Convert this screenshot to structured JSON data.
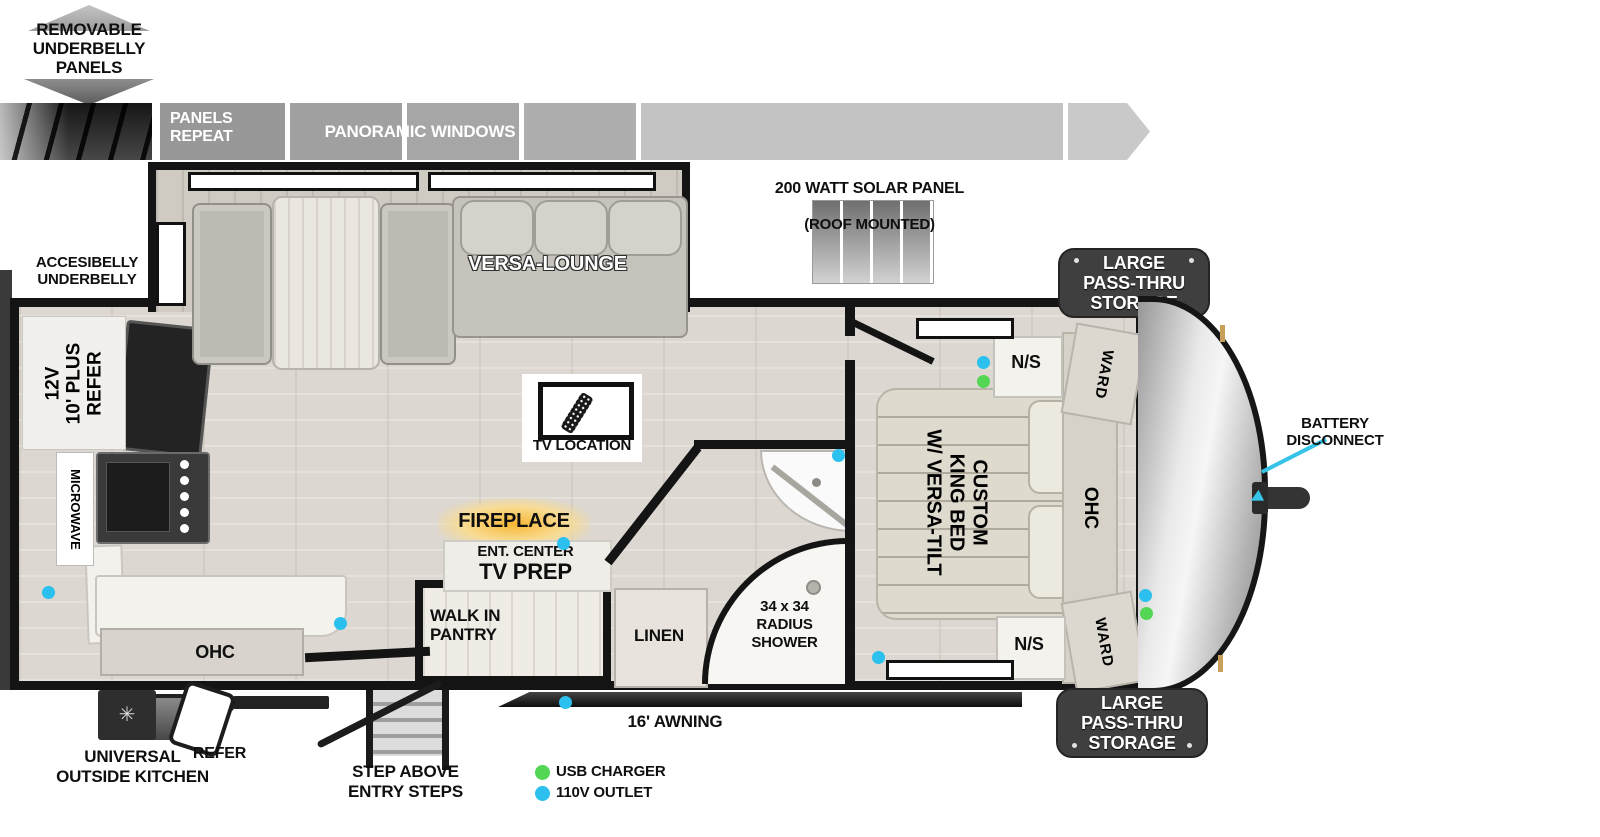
{
  "colors": {
    "wall": "#141414",
    "floor": "#dcd7d0",
    "badge_bg": "#3f3f3f",
    "usb_green": "#53d653",
    "outlet_blue": "#2bc0ee",
    "fireplace_glow": "#f7b733",
    "arrow_cyan": "#35c4e8"
  },
  "icons": {
    "vent_fan_glyph": "✳"
  },
  "roof": {
    "removable_panels": "REMOVABLE\nUNDERBELLY\nPANELS",
    "panels_repeat": "PANELS\nREPEAT",
    "panoramic_windows": "PANORAMIC WINDOWS",
    "solar_title": "200 WATT SOLAR PANEL",
    "solar_subtitle": "(ROOF MOUNTED)"
  },
  "exterior": {
    "accessibelly": "ACCESIBELLY\nUNDERBELLY",
    "battery_disconnect": "BATTERY\nDISCONNECT",
    "pass_thru_storage_top": "LARGE\nPASS-THRU\nSTORAGE",
    "pass_thru_storage_bottom": "LARGE\nPASS-THRU\nSTORAGE",
    "awning": "16' AWNING",
    "universal_outside_kitchen": "UNIVERSAL\nOUTSIDE KITCHEN",
    "outside_refer": "REFER",
    "entry_steps": "STEP ABOVE\nENTRY STEPS"
  },
  "interior": {
    "versa_lounge": "VERSA-LOUNGE",
    "tv_location": "TV LOCATION",
    "refer": "12V\n10' PLUS\nREFER",
    "microwave": "MICROWAVE",
    "kitchen_ohc": "OHC",
    "fireplace": "FIREPLACE",
    "ent_center": "ENT. CENTER",
    "tv_prep": "TV PREP",
    "walk_in_pantry": "WALK IN\nPANTRY",
    "linen": "LINEN",
    "shower": "34 x 34\nRADIUS\nSHOWER",
    "king_bed": "CUSTOM\nKING BED\nW/ VERSA-TILT",
    "nightstand_top": "N/S",
    "nightstand_bottom": "N/S",
    "wardrobe_top": "WARD",
    "wardrobe_bottom": "WARD",
    "bedroom_ohc": "OHC"
  },
  "legend": [
    {
      "label": "USB CHARGER",
      "color": "#53d653"
    },
    {
      "label": "110V OUTLET",
      "color": "#2bc0ee"
    }
  ]
}
